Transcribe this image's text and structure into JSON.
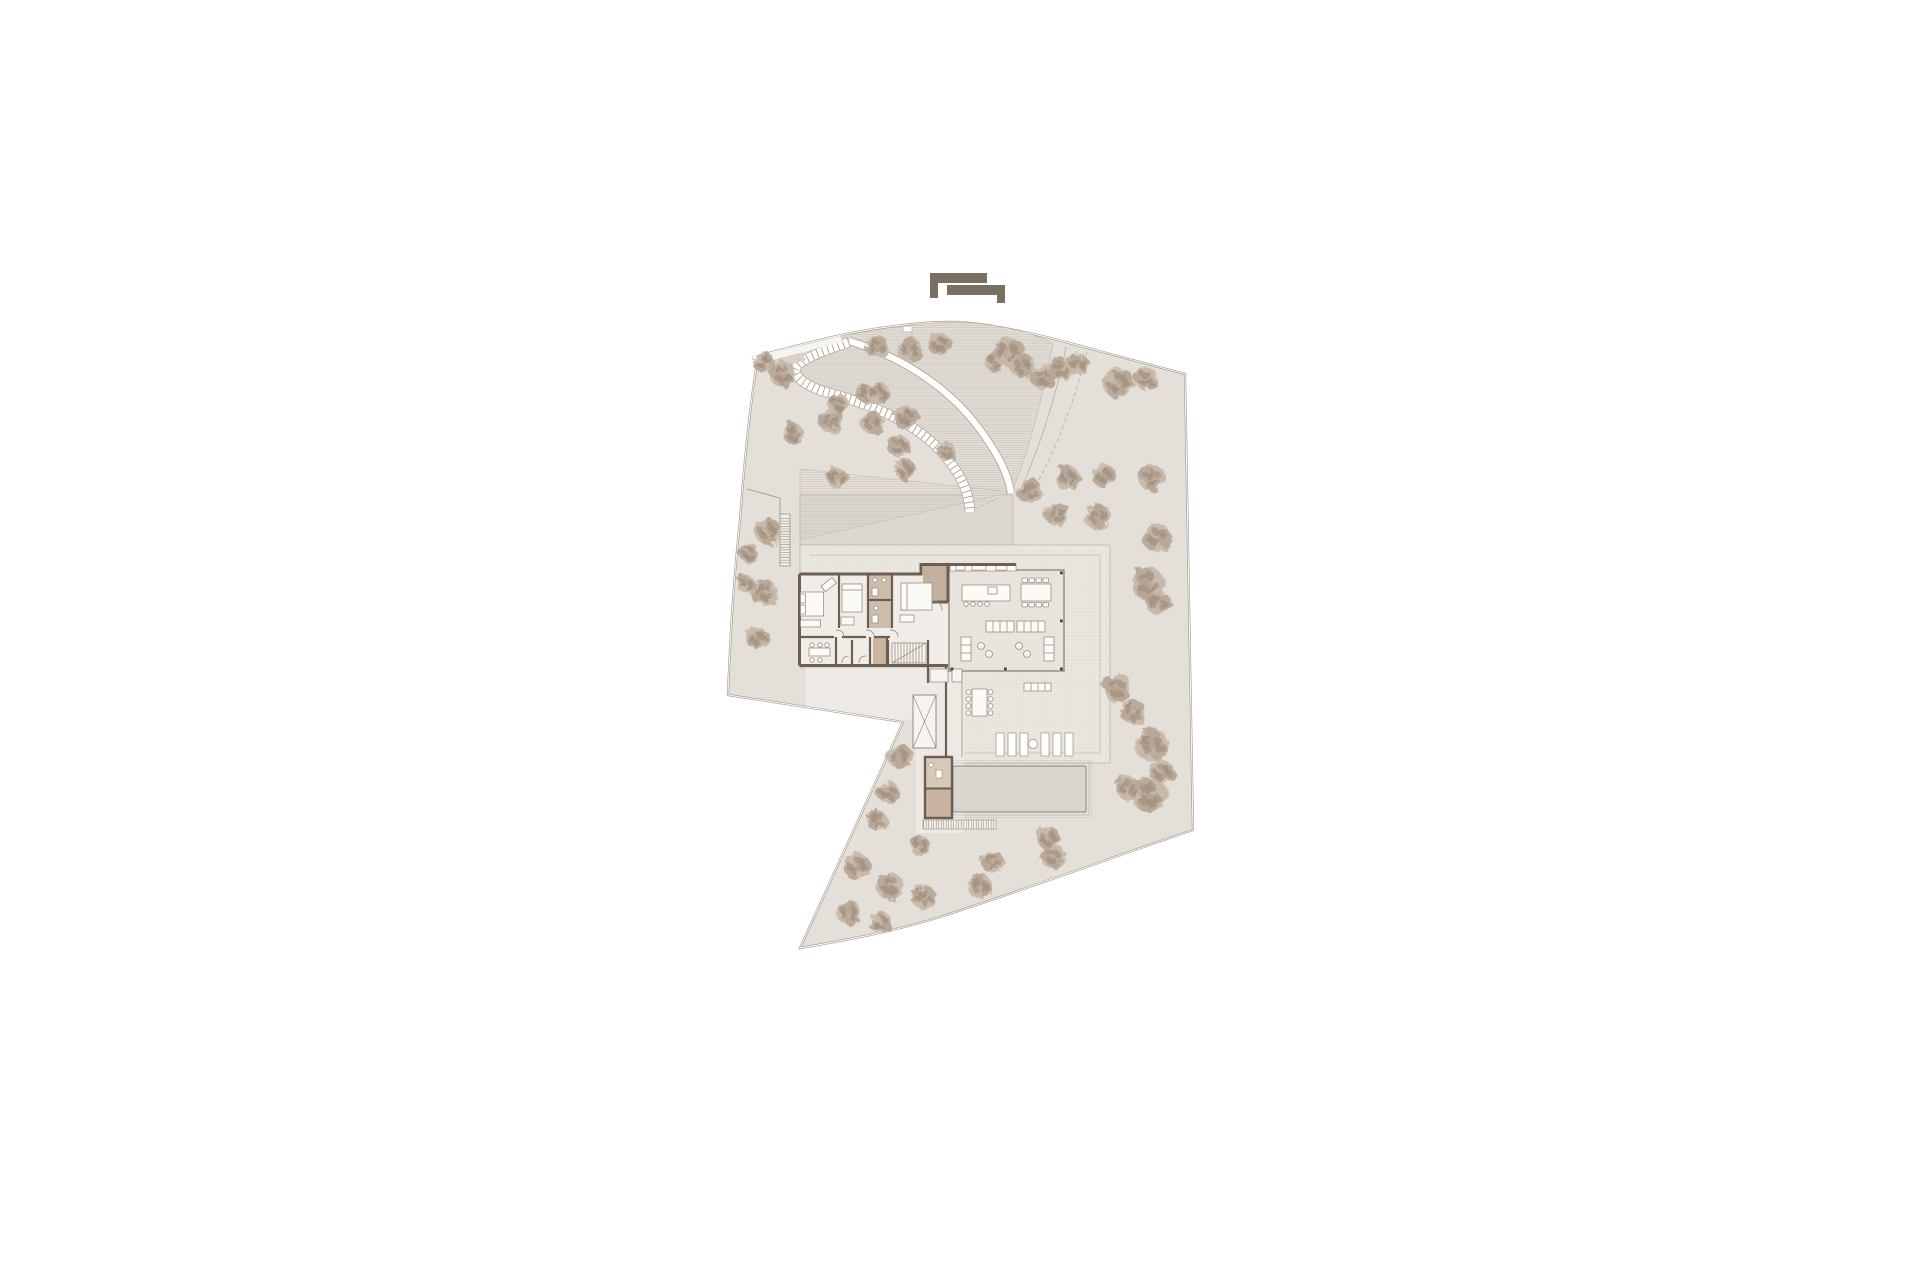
{
  "meta": {
    "description": "Architectural site plan drawing: villa ground/roof floor plan with curved driveway, stepped garden path, tiled terraces, pool and scattered trees on an irregular plot",
    "canvas": {
      "width": 1920,
      "height": 1280
    }
  },
  "logo": {
    "name": "architect-logo-mark",
    "color": "#7b6f61"
  },
  "palette": {
    "page": "#ffffff",
    "site_fill": "#e5dfda",
    "boundary_line": "#a29a8f",
    "forecourt_fill": "#dcd7d1",
    "terrace_fill": "#ebe7e1",
    "grid_line": "#d9d3cb",
    "hatch_fill": "#e2ddd7",
    "hatch_line": "#c8c1b9",
    "white_path": "#ffffff",
    "path_edge": "#aba294",
    "apron_fill": "#edeae5",
    "wall": "#6c5f51",
    "room_fill": "#f0ede9",
    "living_fill": "#e8e3dd",
    "tan_room": "#cdbdab",
    "tan_dark": "#c2b09c",
    "pool_fill": "#dad5cf",
    "pool_edge": "#8d8478",
    "furniture_line": "#9b9084",
    "furniture_fill": "#fbfaf7",
    "tree_light": "#c6b8a9",
    "tree_mid": "#b2a190",
    "tree_dark": "#9c8874",
    "column_dot": "#4a4237"
  },
  "trees": [
    {
      "x": 763,
      "y": 362,
      "r": 10
    },
    {
      "x": 782,
      "y": 374,
      "r": 13
    },
    {
      "x": 877,
      "y": 347,
      "r": 11
    },
    {
      "x": 910,
      "y": 350,
      "r": 12
    },
    {
      "x": 940,
      "y": 344,
      "r": 11
    },
    {
      "x": 996,
      "y": 362,
      "r": 10
    },
    {
      "x": 1008,
      "y": 352,
      "r": 15
    },
    {
      "x": 1022,
      "y": 366,
      "r": 12
    },
    {
      "x": 1043,
      "y": 377,
      "r": 12
    },
    {
      "x": 1060,
      "y": 369,
      "r": 11
    },
    {
      "x": 1078,
      "y": 364,
      "r": 11
    },
    {
      "x": 1118,
      "y": 383,
      "r": 15
    },
    {
      "x": 1146,
      "y": 379,
      "r": 11
    },
    {
      "x": 866,
      "y": 394,
      "r": 9
    },
    {
      "x": 878,
      "y": 393,
      "r": 11
    },
    {
      "x": 906,
      "y": 417,
      "r": 12
    },
    {
      "x": 838,
      "y": 404,
      "r": 10
    },
    {
      "x": 831,
      "y": 421,
      "r": 12
    },
    {
      "x": 872,
      "y": 423,
      "r": 11
    },
    {
      "x": 899,
      "y": 446,
      "r": 11
    },
    {
      "x": 793,
      "y": 433,
      "r": 10
    },
    {
      "x": 837,
      "y": 478,
      "r": 10
    },
    {
      "x": 905,
      "y": 470,
      "r": 10
    },
    {
      "x": 947,
      "y": 452,
      "r": 9
    },
    {
      "x": 1030,
      "y": 491,
      "r": 12
    },
    {
      "x": 1068,
      "y": 478,
      "r": 12
    },
    {
      "x": 1103,
      "y": 475,
      "r": 11
    },
    {
      "x": 1152,
      "y": 478,
      "r": 13
    },
    {
      "x": 1057,
      "y": 514,
      "r": 12
    },
    {
      "x": 1098,
      "y": 517,
      "r": 13
    },
    {
      "x": 1157,
      "y": 537,
      "r": 14
    },
    {
      "x": 1148,
      "y": 583,
      "r": 16
    },
    {
      "x": 1158,
      "y": 603,
      "r": 12
    },
    {
      "x": 768,
      "y": 532,
      "r": 13
    },
    {
      "x": 749,
      "y": 553,
      "r": 10
    },
    {
      "x": 764,
      "y": 592,
      "r": 13
    },
    {
      "x": 746,
      "y": 584,
      "r": 9
    },
    {
      "x": 757,
      "y": 638,
      "r": 11
    },
    {
      "x": 1117,
      "y": 688,
      "r": 14
    },
    {
      "x": 1133,
      "y": 712,
      "r": 12
    },
    {
      "x": 1152,
      "y": 745,
      "r": 16
    },
    {
      "x": 1162,
      "y": 772,
      "r": 12
    },
    {
      "x": 1150,
      "y": 795,
      "r": 17
    },
    {
      "x": 1128,
      "y": 788,
      "r": 12
    },
    {
      "x": 900,
      "y": 757,
      "r": 12
    },
    {
      "x": 888,
      "y": 792,
      "r": 11
    },
    {
      "x": 877,
      "y": 820,
      "r": 10
    },
    {
      "x": 920,
      "y": 845,
      "r": 10
    },
    {
      "x": 1048,
      "y": 838,
      "r": 11
    },
    {
      "x": 1053,
      "y": 857,
      "r": 12
    },
    {
      "x": 993,
      "y": 862,
      "r": 11
    },
    {
      "x": 980,
      "y": 886,
      "r": 12
    },
    {
      "x": 857,
      "y": 866,
      "r": 13
    },
    {
      "x": 890,
      "y": 886,
      "r": 13
    },
    {
      "x": 923,
      "y": 897,
      "r": 12
    },
    {
      "x": 849,
      "y": 913,
      "r": 12
    },
    {
      "x": 881,
      "y": 923,
      "r": 11
    }
  ],
  "loungers": {
    "count": 6,
    "xs": [
      996,
      1008,
      1020,
      1041,
      1053,
      1065
    ],
    "y": 733,
    "width": 8,
    "height": 23,
    "table": {
      "cx": 1033,
      "cy": 744,
      "r": 4.5
    }
  },
  "furniture_counts": {
    "indoor_dining_chairs": 8,
    "island_stools": 4,
    "outdoor_dining_chairs": 8,
    "bedrooms": 3
  }
}
